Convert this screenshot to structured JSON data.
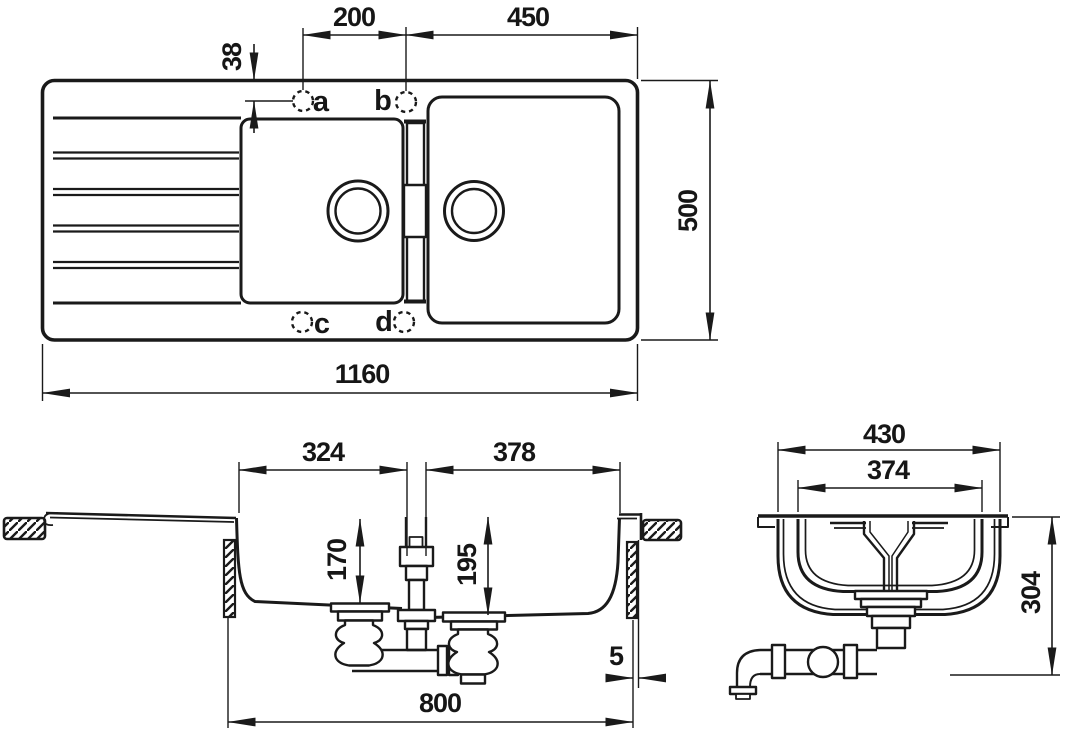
{
  "drawing": {
    "colors": {
      "line": "#1a1a1a",
      "background": "#ffffff"
    },
    "top_view": {
      "dims": {
        "hole_spacing": "200",
        "right_bowl_to_edge": "450",
        "hole_edge_offset": "38",
        "overall_width": "500",
        "overall_length": "1160"
      },
      "hole_labels": {
        "a": "a",
        "b": "b",
        "c": "c",
        "d": "d"
      }
    },
    "side_section": {
      "dims": {
        "left_bowl_top_width": "324",
        "right_bowl_top_width": "378",
        "left_bowl_depth": "170",
        "right_bowl_depth": "195",
        "edge_gap": "5",
        "cutout_length": "800"
      }
    },
    "end_section": {
      "dims": {
        "bowl_outer_width": "430",
        "bowl_inner_width": "374",
        "overall_height": "304"
      }
    }
  }
}
